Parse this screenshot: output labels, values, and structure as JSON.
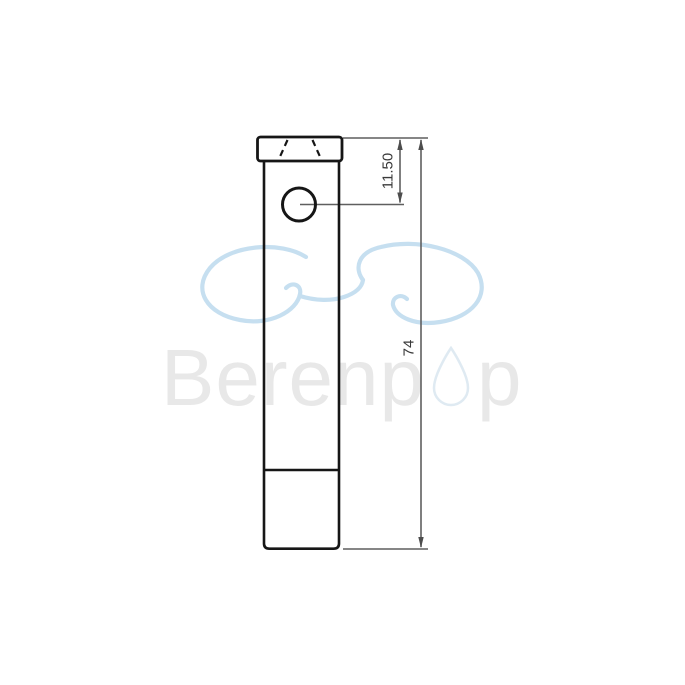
{
  "watermark": {
    "brand_left": "Berenp",
    "brand_right": "p"
  },
  "dimensions": {
    "hole_center_offset": "11.50",
    "overall_length": "74"
  },
  "colors": {
    "background": "#ffffff",
    "part_outline": "#161616",
    "dimension_line": "#5f5f5f",
    "dimension_text": "#3a3a3a",
    "watermark_text": "#e8e8e8",
    "watermark_cloud": "#c6dff0",
    "watermark_droplet": "#dfeaf2"
  }
}
